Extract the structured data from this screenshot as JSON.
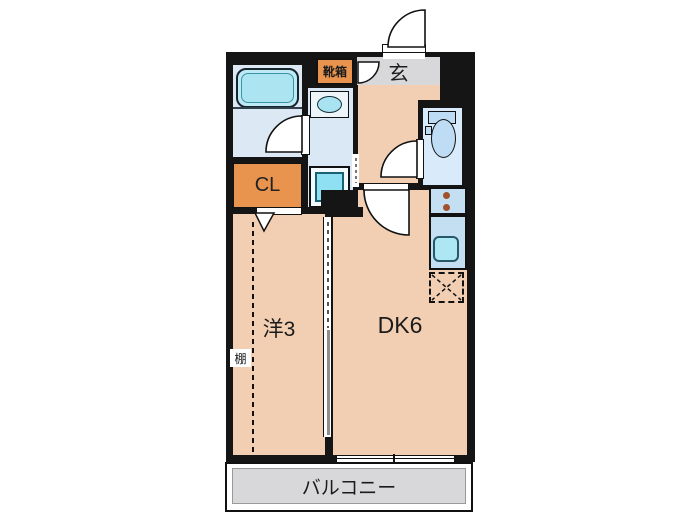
{
  "floor_plan": {
    "rooms": {
      "entrance": {
        "label": "玄"
      },
      "shoe_box": {
        "label": "靴箱"
      },
      "closet": {
        "label": "CL"
      },
      "western_room": {
        "label": "洋3"
      },
      "dining_kitchen": {
        "label": "DK6"
      },
      "shelf": {
        "label": "棚"
      },
      "balcony": {
        "label": "バルコニー"
      }
    },
    "fixtures": [
      "bathtub",
      "washbasin",
      "washing-machine-pan",
      "toilet",
      "gas-burners",
      "kitchen-sink",
      "refrigerator-space",
      "sliding-partition",
      "sliding-window",
      "entry-door"
    ],
    "colors": {
      "wall": "#151515",
      "room_beige": "#F2CFB3",
      "room_blue": "#DCE9F5",
      "fixture_cyan": "#ACE4F2",
      "accent_orange": "#E8944F",
      "gray_area": "#D8D7D9",
      "counter_blue": "#C4DFF1",
      "burner_brown": "#A0522D"
    }
  }
}
